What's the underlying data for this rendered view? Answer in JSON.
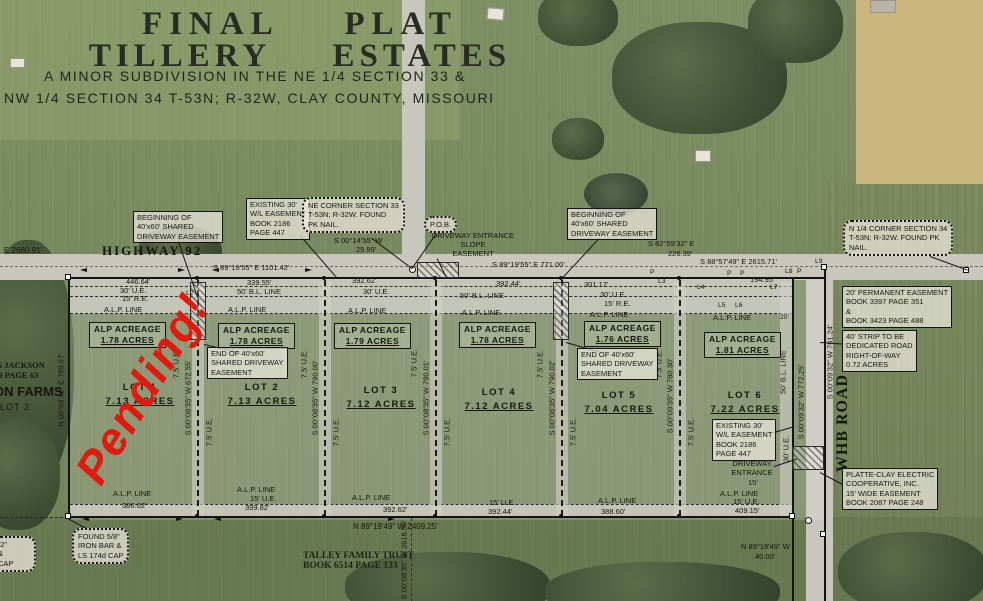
{
  "watermark": {
    "text": "Pending!",
    "color": "#e2190e"
  },
  "title": {
    "line1": "FINAL  PLAT",
    "line2": "TILLERY  ESTATES",
    "line3": "A MINOR SUBDIVISION IN THE NE 1/4 SECTION 33 &",
    "line4": "NW 1/4 SECTION 34 T-53N; R-32W, CLAY COUNTY, MISSOURI"
  },
  "roads": {
    "highway": "HIGHWAY 92",
    "whb": "WHB ROAD"
  },
  "adjoiners": {
    "jackson_line1": "N JACKSON",
    "jackson_line2": "39 PAGE 63",
    "farms": "ON FARMS",
    "farms_lot": "LOT 3",
    "talley_line1": "TALLEY FAMILY TRUST",
    "talley_line2": "BOOK 6514 PAGE 133"
  },
  "boundary": {
    "west_overall": "E  2660.91'",
    "top_bearing_1": "S 89°19'55\" E   1101.42'",
    "top_bearing_2": "S 89°19'55\" E   771.00'",
    "top_bearing_3": "S 82°59'32\" E",
    "top_bearing_3_dist": "226.39'",
    "top_bearing_4": "S 88°57'49\" E   2615.71'",
    "jog_bearing": "S 00°14'55\" W",
    "jog_dist": "29.99'",
    "seg_446": "446.64'",
    "seg_339": "339.55'",
    "seg_392a": "392.62'",
    "seg_392b": "392.44'",
    "seg_301": "301.17'",
    "seg_194": "194.95'",
    "west_bearing": "N 00°09'42\" E   789.97'",
    "bottom_bearing": "N 89°19'49\" W   2409.25'",
    "bottom_road_bearing": "N 89°19'49\" W",
    "bottom_road_dist": "40.00'",
    "south_section": "S 00°08'35\" W   2618.50'",
    "east_road": "S 00°09'32\" W  761.24'"
  },
  "lots": [
    {
      "name": "LOT 1",
      "acres": "7.13 ACRES",
      "alp": "1.78 ACRES",
      "bottom": "386.62'",
      "east": "S 00°08'35\" W  672.55'"
    },
    {
      "name": "LOT 2",
      "acres": "7.13 ACRES",
      "alp": "1.78 ACRES",
      "bottom": "399.82'",
      "east": "S 00°08'35\" W  790.00'"
    },
    {
      "name": "LOT 3",
      "acres": "7.12 ACRES",
      "alp": "1.79 ACRES",
      "bottom": "392.62'",
      "east": "S 00°08'35\" W  790.01'"
    },
    {
      "name": "LOT 4",
      "acres": "7.12 ACRES",
      "alp": "1.78 ACRES",
      "bottom": "392.44'",
      "east": "S 00°08'35\" W  790.02'"
    },
    {
      "name": "LOT 5",
      "acres": "7.04 ACRES",
      "alp": "1.76 ACRES",
      "bottom": "388.60'",
      "east": "S 00°09'35\" W  780.30'"
    },
    {
      "name": "LOT 6",
      "acres": "7.22 ACRES",
      "alp": "1.81 ACRES",
      "bottom": "409.15'",
      "east": "S 00°09'32\" W  772.25'"
    }
  ],
  "labels": {
    "alp_acreage": "ALP ACREAGE",
    "alp_line": "A.L.P. LINE",
    "ue30": "30' U.E.",
    "ue15": "15' U.E.",
    "ue75": "7.5' U.E.",
    "re15": "15' R.E.",
    "bl50": "50' B.L. LINE",
    "d20": "20'",
    "d15": "15'",
    "p": "P",
    "l2": "L2",
    "l3": "L3",
    "l4": "L4",
    "l5": "L5",
    "l6": "L6",
    "l7": "L7",
    "l8": "L8",
    "l9": "L9"
  },
  "callouts": {
    "beginning_easement": [
      "BEGINNING OF",
      "40'x60' SHARED",
      "DRIVEWAY EASEMENT"
    ],
    "end_easement": [
      "END OF 40'x60'",
      "SHARED DRIVEWAY",
      "EASEMENT"
    ],
    "existing_wl": [
      "EXISTING 30'",
      "W/L EASEMENT",
      "BOOK 2186",
      "PAGE 447"
    ],
    "ne_corner": [
      "NE CORNER SECTION 33",
      "T-53N; R-32W. FOUND",
      "PK NAIL."
    ],
    "n14_corner": [
      "N 1/4 CORNER SECTION 34",
      "T-53N; R-32W. FOUND PK",
      "NAIL."
    ],
    "pob": "P.O.B.",
    "slope": [
      "DRIVEWAY  ENTRANCE",
      "SLOPE",
      "EASEMENT"
    ],
    "perm_easement": [
      "20' PERMANENT EASEMENT",
      "BOOK 3397 PAGE 351",
      "&",
      "BOOK 3423 PAGE 488"
    ],
    "strip": [
      "40' STRIP TO BE",
      "DEDICATED ROAD",
      "RIGHT-OF-WAY",
      "0.72 ACRES"
    ],
    "platte": [
      "PLATTE-CLAY ELECTRIC",
      "COOPERATIVE, INC.",
      "15' WIDE EASEMENT",
      "BOOK 2087 PAGE 248"
    ],
    "driveway_entrance": [
      "DRIVEWAY",
      "ENTRANCE"
    ],
    "found58": [
      "FOUND 5/8\"",
      "IRON BAR &",
      "LS 174d CAP"
    ],
    "found_partial": [
      "/2\"",
      "&",
      "CAP"
    ]
  }
}
